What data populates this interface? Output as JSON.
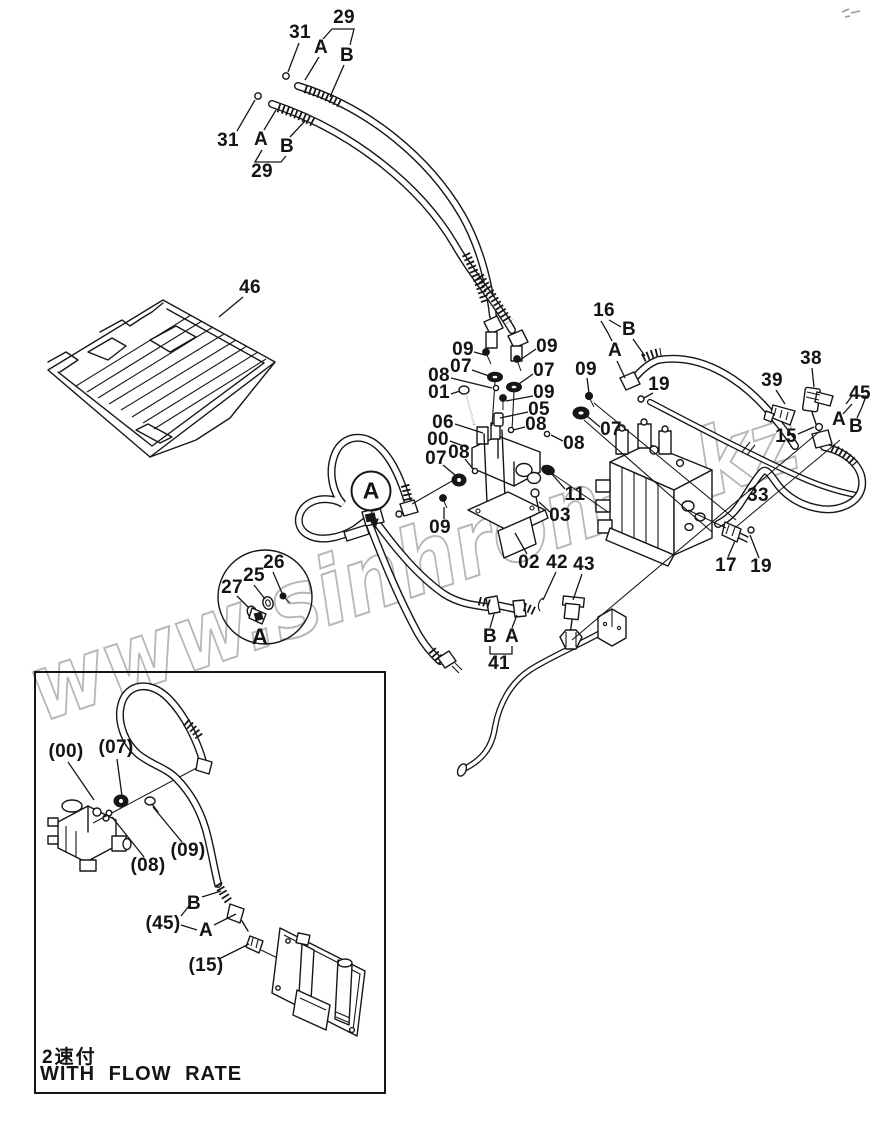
{
  "watermark": {
    "text": "www.sinhron-t.kz",
    "color": "#b7b7b7"
  },
  "detail_marker": {
    "label": "A"
  },
  "callouts": [
    {
      "t": "29",
      "x": 344,
      "y": 18
    },
    {
      "t": "31",
      "x": 300,
      "y": 33
    },
    {
      "t": "A",
      "x": 321,
      "y": 48
    },
    {
      "t": "B",
      "x": 347,
      "y": 56
    },
    {
      "t": "31",
      "x": 228,
      "y": 141
    },
    {
      "t": "A",
      "x": 261,
      "y": 140
    },
    {
      "t": "B",
      "x": 287,
      "y": 147
    },
    {
      "t": "29",
      "x": 262,
      "y": 172
    },
    {
      "t": "46",
      "x": 250,
      "y": 288
    },
    {
      "t": "09",
      "x": 463,
      "y": 350
    },
    {
      "t": "09",
      "x": 547,
      "y": 347
    },
    {
      "t": "07",
      "x": 461,
      "y": 367
    },
    {
      "t": "07",
      "x": 544,
      "y": 371
    },
    {
      "t": "08",
      "x": 439,
      "y": 376
    },
    {
      "t": "01",
      "x": 439,
      "y": 393
    },
    {
      "t": "09",
      "x": 544,
      "y": 393
    },
    {
      "t": "05",
      "x": 539,
      "y": 410
    },
    {
      "t": "06",
      "x": 443,
      "y": 423
    },
    {
      "t": "08",
      "x": 536,
      "y": 425
    },
    {
      "t": "00",
      "x": 438,
      "y": 440
    },
    {
      "t": "08",
      "x": 459,
      "y": 453
    },
    {
      "t": "07",
      "x": 436,
      "y": 459
    },
    {
      "t": "09",
      "x": 440,
      "y": 528
    },
    {
      "t": "09",
      "x": 586,
      "y": 370
    },
    {
      "t": "07",
      "x": 611,
      "y": 430
    },
    {
      "t": "08",
      "x": 574,
      "y": 444
    },
    {
      "t": "11",
      "x": 575,
      "y": 495
    },
    {
      "t": "16",
      "x": 604,
      "y": 311
    },
    {
      "t": "B",
      "x": 629,
      "y": 330
    },
    {
      "t": "A",
      "x": 615,
      "y": 351
    },
    {
      "t": "19",
      "x": 659,
      "y": 385
    },
    {
      "t": "39",
      "x": 772,
      "y": 381
    },
    {
      "t": "38",
      "x": 811,
      "y": 359
    },
    {
      "t": "45",
      "x": 860,
      "y": 394
    },
    {
      "t": "A",
      "x": 839,
      "y": 420
    },
    {
      "t": "B",
      "x": 856,
      "y": 427
    },
    {
      "t": "15",
      "x": 786,
      "y": 437
    },
    {
      "t": "33",
      "x": 758,
      "y": 496
    },
    {
      "t": "17",
      "x": 726,
      "y": 566
    },
    {
      "t": "19",
      "x": 761,
      "y": 567
    },
    {
      "t": "03",
      "x": 560,
      "y": 516
    },
    {
      "t": "02",
      "x": 529,
      "y": 563
    },
    {
      "t": "42",
      "x": 557,
      "y": 563
    },
    {
      "t": "43",
      "x": 584,
      "y": 565
    },
    {
      "t": "B",
      "x": 490,
      "y": 637
    },
    {
      "t": "A",
      "x": 512,
      "y": 637
    },
    {
      "t": "41",
      "x": 499,
      "y": 664
    },
    {
      "t": "26",
      "x": 274,
      "y": 563
    },
    {
      "t": "25",
      "x": 254,
      "y": 576
    },
    {
      "t": "27",
      "x": 232,
      "y": 588
    },
    {
      "t": "A",
      "x": 260,
      "y": 637,
      "fs": 22
    }
  ],
  "inset": {
    "caption_jp": "2速付",
    "caption_en": "WITH FLOW RATE",
    "labels": [
      {
        "t": "(00)",
        "x": 66,
        "y": 752
      },
      {
        "t": "(07)",
        "x": 116,
        "y": 748
      },
      {
        "t": "(08)",
        "x": 148,
        "y": 866
      },
      {
        "t": "(09)",
        "x": 188,
        "y": 851
      },
      {
        "t": "B",
        "x": 194,
        "y": 904
      },
      {
        "t": "(45)",
        "x": 163,
        "y": 924
      },
      {
        "t": "A",
        "x": 206,
        "y": 931
      },
      {
        "t": "(15)",
        "x": 206,
        "y": 966
      }
    ]
  }
}
